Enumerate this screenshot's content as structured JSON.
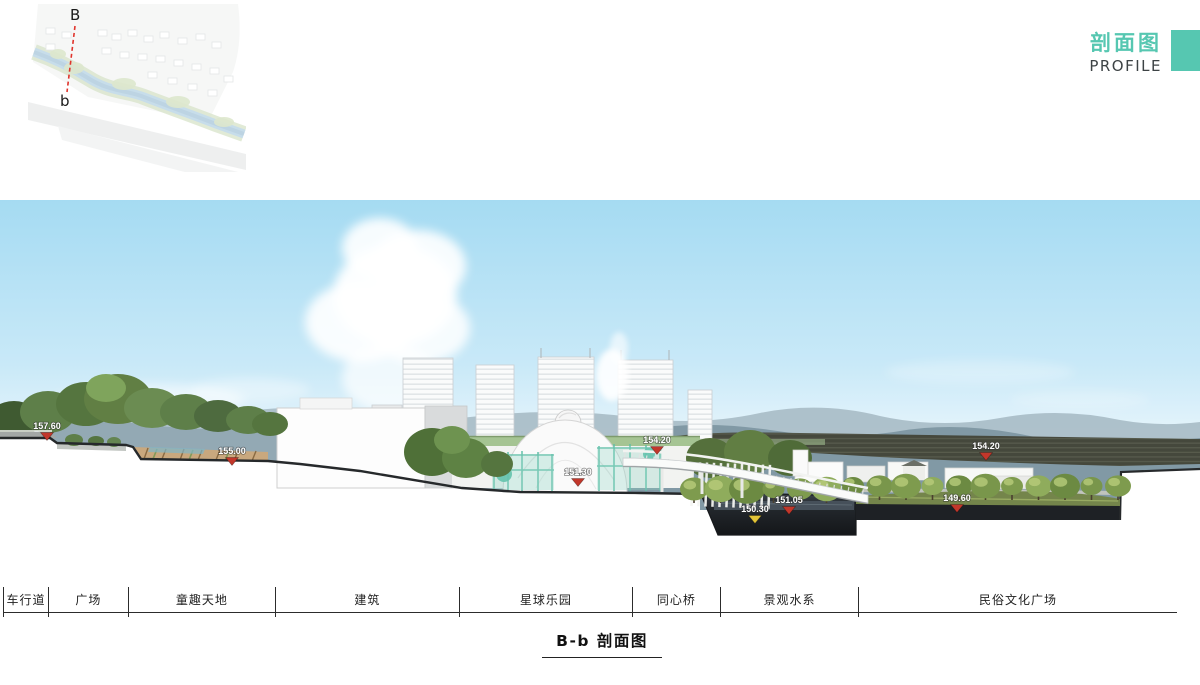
{
  "header": {
    "title_cn": "剖面图",
    "title_en": "PROFILE"
  },
  "locator_map": {
    "point_top": "B",
    "point_bottom": "b"
  },
  "caption": {
    "text": "B-b 剖面图"
  },
  "section_bar": {
    "labels": [
      {
        "label": "车行道",
        "width_pct": 3.83
      },
      {
        "label": "广场",
        "width_pct": 6.81
      },
      {
        "label": "童趣天地",
        "width_pct": 12.52
      },
      {
        "label": "建筑",
        "width_pct": 15.67
      },
      {
        "label": "星球乐园",
        "width_pct": 14.74
      },
      {
        "label": "同心桥",
        "width_pct": 7.5
      },
      {
        "label": "景观水系",
        "width_pct": 11.76
      },
      {
        "label": "民俗文化广场",
        "width_pct": 27.17
      }
    ]
  },
  "elevation_markers": [
    {
      "value": "157.60",
      "x": 47,
      "y": 229,
      "tri_color": "#c2372b"
    },
    {
      "value": "155.00",
      "x": 232,
      "y": 254,
      "tri_color": "#c2372b"
    },
    {
      "value": "151.30",
      "x": 578,
      "y": 275,
      "tri_color": "#c2372b"
    },
    {
      "value": "154.20",
      "x": 657,
      "y": 243,
      "tri_color": "#c2372b"
    },
    {
      "value": "150.30",
      "x": 755,
      "y": 312,
      "tri_color": "#e3c437"
    },
    {
      "value": "151.05",
      "x": 789,
      "y": 303,
      "tri_color": "#c2372b"
    },
    {
      "value": "149.60",
      "x": 957,
      "y": 301,
      "tri_color": "#c2372b"
    },
    {
      "value": "154.20",
      "x": 986,
      "y": 249,
      "tri_color": "#c2372b"
    }
  ],
  "colors": {
    "accent": "#56C7B1",
    "marker_red": "#c2372b",
    "marker_yellow": "#e3c437"
  }
}
